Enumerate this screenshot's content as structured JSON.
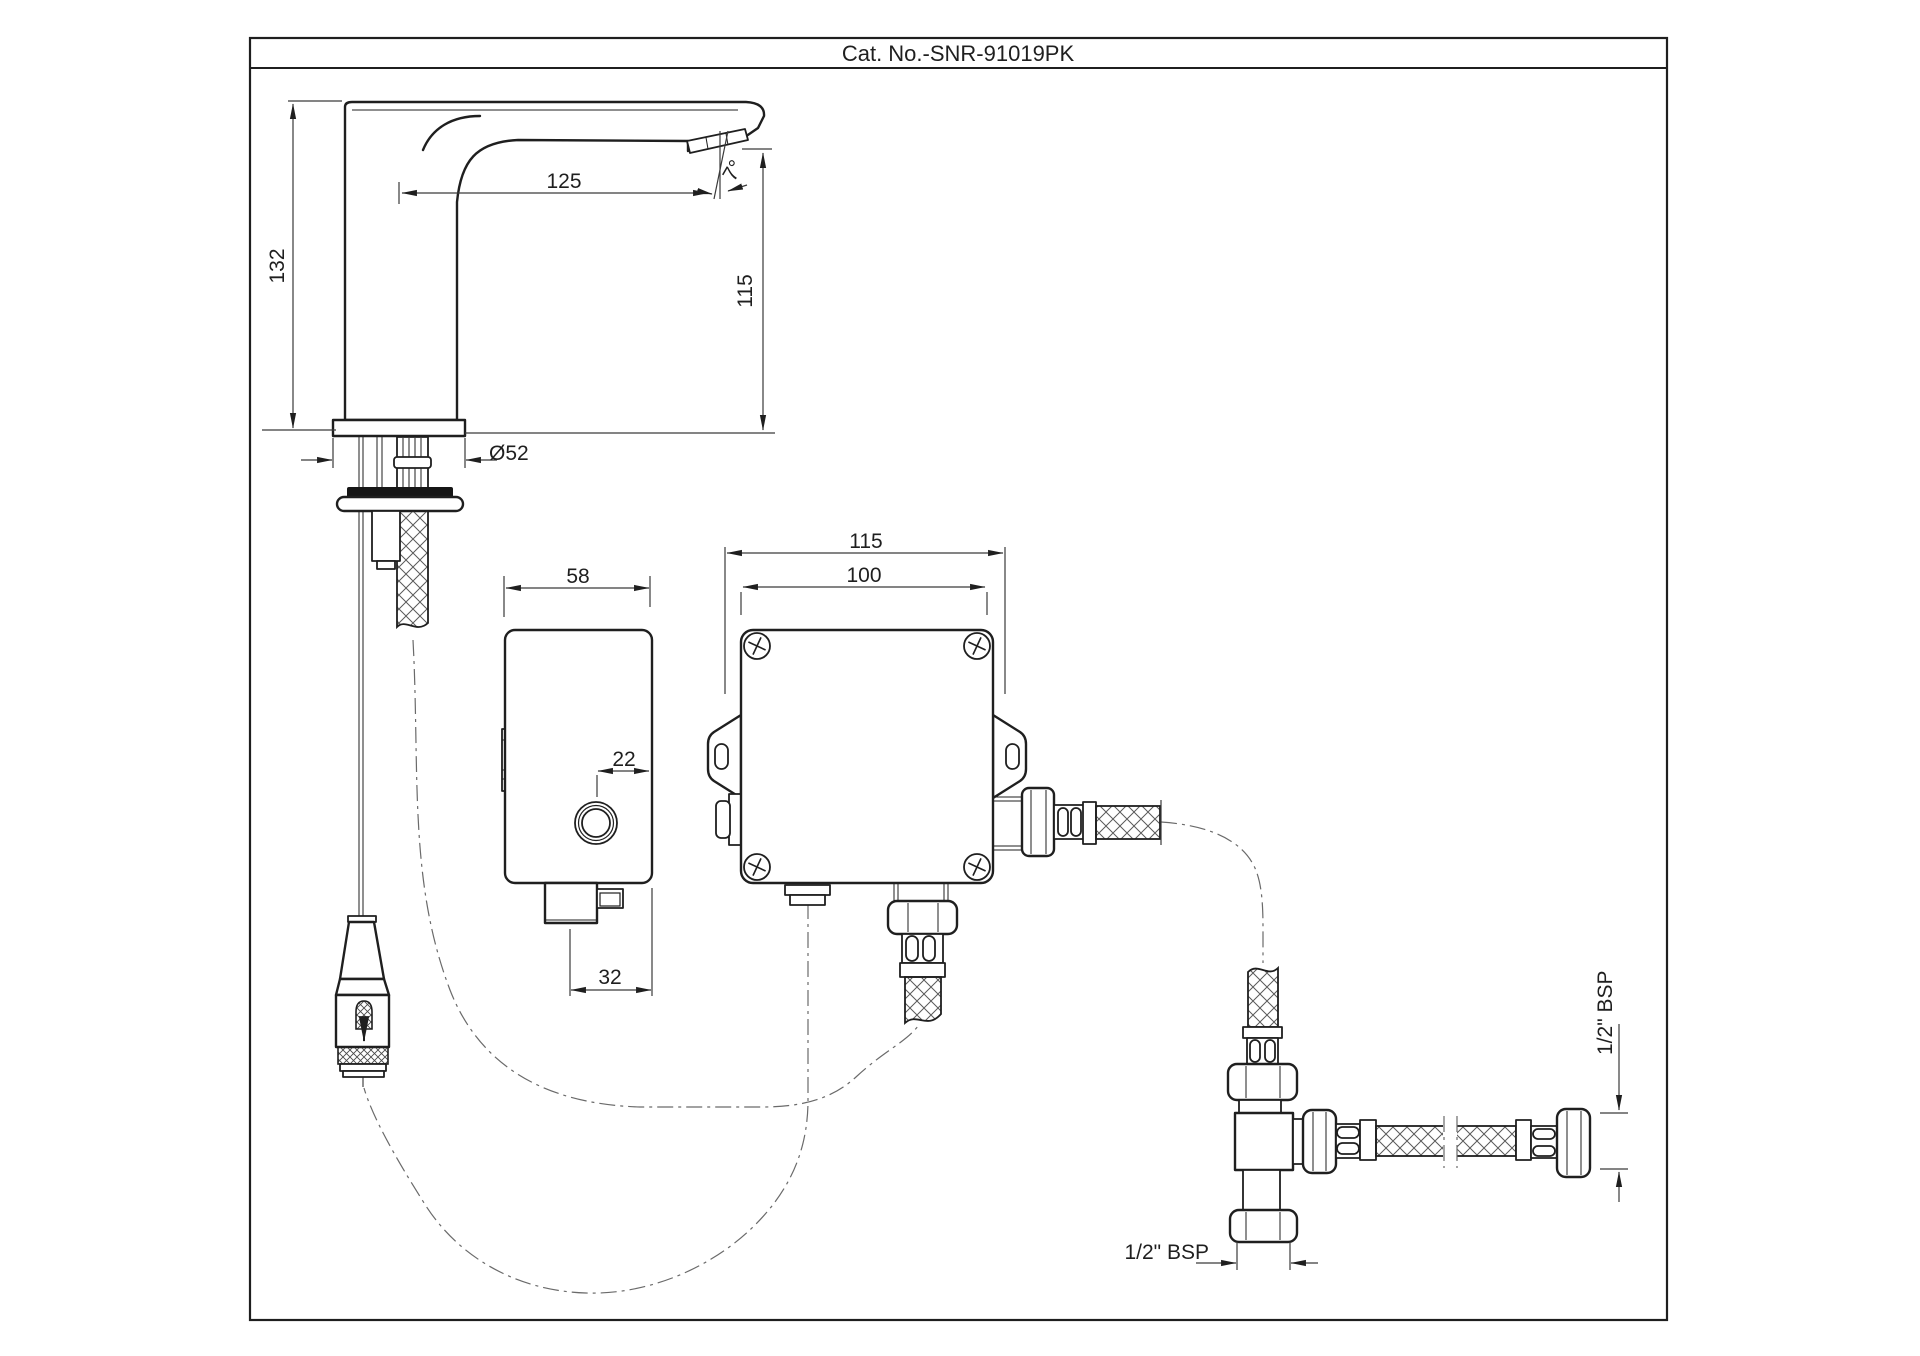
{
  "title_block": {
    "catalog_number": "Cat. No.-SNR-91019PK"
  },
  "dimensions": {
    "faucet_overall_height": "132",
    "spout_reach": "125",
    "aerator_angle": "7°",
    "spout_outlet_height": "115",
    "base_diameter": "Ø52",
    "control_unit_width": "58",
    "button_offset": "22",
    "control_unit_depth": "32",
    "valve_box_width": "115",
    "valve_box_mounting_width": "100",
    "inlet_thread_size_bottom": "1/2\" BSP",
    "inlet_thread_size_right": "1/2\" BSP"
  }
}
